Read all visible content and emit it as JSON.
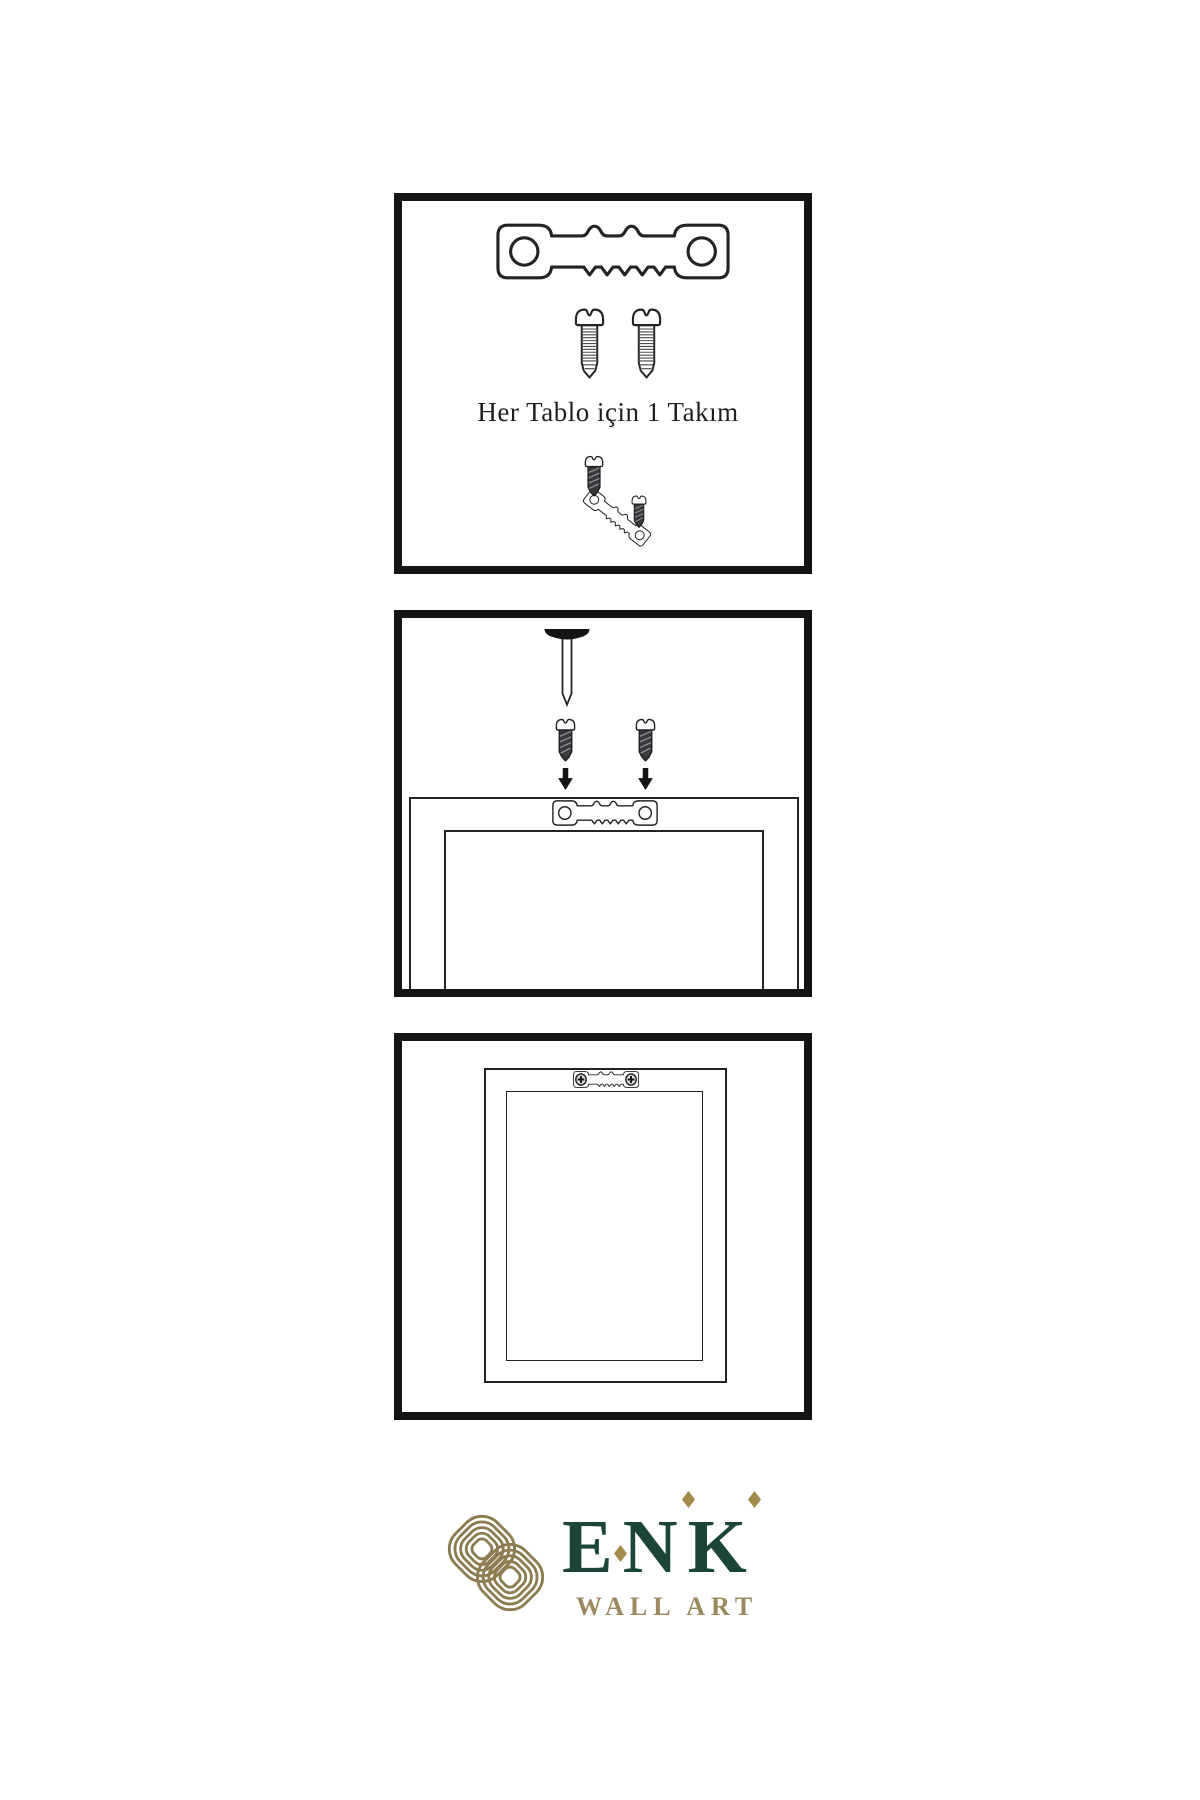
{
  "page": {
    "background": "#ffffff",
    "line_color": "#232323"
  },
  "panels": {
    "hardware_kit": {
      "caption": "Her Tablo için 1 Takım",
      "items": [
        "sawtooth-hanger",
        "screw",
        "screw",
        "screw",
        "angled-sawtooth-hanger",
        "screw"
      ]
    },
    "mounting_step": {
      "items": [
        "wall-nail",
        "screw",
        "screw",
        "down-arrow",
        "down-arrow",
        "frame-back",
        "sawtooth-hanger"
      ]
    },
    "hanging_step": {
      "items": [
        "frame-back",
        "sawtooth-hanger-installed",
        "phillips-screw",
        "phillips-screw"
      ]
    }
  },
  "brand": {
    "name": "ENK",
    "subtitle": "WALL ART",
    "green": "#1c4539",
    "knot_gold": "#8c7c50",
    "text_gold": "#9c8a5e",
    "diamond_gold": "#a18a4c"
  }
}
